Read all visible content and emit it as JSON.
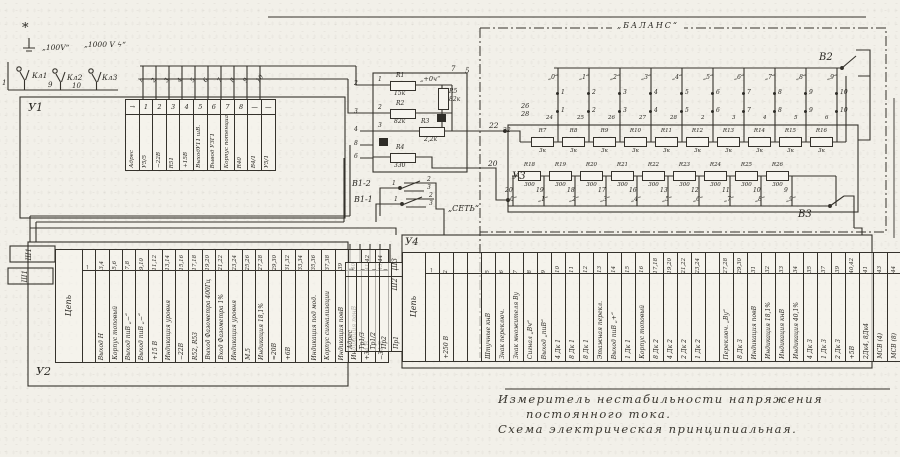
{
  "caption": {
    "line1": "Измеритель  нестабильности  напряжения",
    "line2": "постоянного  тока.",
    "line3": "Схема  электрическая  принципиальная."
  },
  "labels": {
    "star": "*",
    "u1": "У1",
    "u2": "У2",
    "u3": "У3",
    "u4": "У4",
    "v2": "В2",
    "v3": "В3",
    "v12": "В1-2",
    "v11": "В1-1",
    "balance": "„БАЛАНС“",
    "net": "„СЕТЬ“",
    "kl1": "Кл1",
    "kl2": "Кл2",
    "kl3": "Кл3",
    "term1": "1",
    "term9": "9",
    "term10": "10",
    "v100": "„100V“",
    "v1000": "„1000 V ϟ“",
    "sh1a": "Ш1",
    "sh1b": "Ш1",
    "sh3": "Ш3",
    "sh2": "Ш2",
    "bus22": "22",
    "bus22b": "22",
    "bus20": "20",
    "bus26": "26",
    "bus28": "28",
    "node7": "7",
    "node5": "5",
    "plus04": "„+0ч“",
    "sw11_1": "1",
    "sw12_1": "1",
    "c2a": "2",
    "c3a": "3",
    "c2b": "2",
    "c3b": "3"
  },
  "r_block": {
    "pins": [
      "2",
      "3",
      "4",
      "8",
      "6"
    ],
    "taps": [
      "1",
      "2",
      "3"
    ],
    "r1": {
      "name": "R1",
      "value": "15к"
    },
    "r2": {
      "name": "R2",
      "value": "82к"
    },
    "r5": {
      "name": "R5",
      "value": "82к"
    },
    "r3": {
      "name": "R3",
      "value": "2,2к"
    },
    "r4": {
      "name": "R4",
      "value": "330"
    }
  },
  "balance": {
    "positions": [
      "„0“",
      "„1“",
      "„2“",
      "„3“",
      "„4“",
      "„5“",
      "„6“",
      "„7“",
      "„8“",
      "„9“"
    ],
    "contacts_top": [
      "1",
      "2",
      "3",
      "4",
      "5",
      "6",
      "7",
      "8",
      "9",
      "10"
    ],
    "contacts_mid": [
      "1",
      "2",
      "3",
      "4",
      "5",
      "6",
      "7",
      "8",
      "9",
      "10"
    ],
    "contacts_mid2": [
      "24",
      "25",
      "26",
      "27",
      "28",
      "2",
      "3",
      "4",
      "5",
      "6"
    ],
    "row1": [
      {
        "name": "R7",
        "value": "3к"
      },
      {
        "name": "R8",
        "value": "3к"
      },
      {
        "name": "R9",
        "value": "3к"
      },
      {
        "name": "R10",
        "value": "3к"
      },
      {
        "name": "R11",
        "value": "3к"
      },
      {
        "name": "R12",
        "value": "3к"
      },
      {
        "name": "R13",
        "value": "3к"
      },
      {
        "name": "R14",
        "value": "3к"
      },
      {
        "name": "R15",
        "value": "3к"
      },
      {
        "name": "R16",
        "value": "3к"
      }
    ],
    "row2": [
      {
        "name": "R18",
        "value": "300"
      },
      {
        "name": "R19",
        "value": "300"
      },
      {
        "name": "R20",
        "value": "300"
      },
      {
        "name": "R21",
        "value": "300"
      },
      {
        "name": "R22",
        "value": "300"
      },
      {
        "name": "R23",
        "value": "300"
      },
      {
        "name": "R24",
        "value": "300"
      },
      {
        "name": "R25",
        "value": "300"
      },
      {
        "name": "R26",
        "value": "300"
      }
    ],
    "nodes": [
      "20",
      "19",
      "18",
      "17",
      "16",
      "13",
      "12",
      "11",
      "10",
      "9"
    ],
    "node_pos": [
      "„0“",
      "„1“",
      "„2“",
      "„3“",
      "„4“",
      "„5“",
      "„6“",
      "„7“",
      "„8“",
      "„9“"
    ]
  },
  "u1_top_pins": [
    "1",
    "2",
    "3",
    "4",
    "5",
    "6",
    "7",
    "8",
    "9",
    "10"
  ],
  "u1_table": {
    "cols": [
      {
        "pin": "→",
        "label": "Адрес"
      },
      {
        "pin": "1",
        "label": "У5/5"
      },
      {
        "pin": "2",
        "label": "−22В"
      },
      {
        "pin": "3",
        "label": "R51"
      },
      {
        "pin": "4",
        "label": "+15В"
      },
      {
        "pin": "5",
        "label": "ВыходУ11 шВ."
      },
      {
        "pin": "6",
        "label": "Вывод УЗГ1"
      },
      {
        "pin": "7",
        "label": "Корпус потенциальн."
      },
      {
        "pin": "8",
        "label": "R40"
      },
      {
        "pin": "—",
        "label": "В4/1"
      },
      {
        "pin": "—",
        "label": "У5/1"
      }
    ]
  },
  "sh1_table": {
    "header": "Цепь",
    "cols": [
      {
        "pin": "→",
        "label": ""
      },
      {
        "pin": "3,4",
        "label": "Выход Н"
      },
      {
        "pin": "5,6",
        "label": "Корпус топовый"
      },
      {
        "pin": "7,8",
        "label": "Выход пиВ „−“"
      },
      {
        "pin": "9,10",
        "label": "Выход пиВ „−“"
      },
      {
        "pin": "11,12",
        "label": "+15 В"
      },
      {
        "pin": "13,14",
        "label": "Индикация уровня"
      },
      {
        "pin": "15,16",
        "label": "−22В"
      },
      {
        "pin": "17,18",
        "label": "R52, R53"
      },
      {
        "pin": "19,20",
        "label": "Выход Фазометра 400Гц"
      },
      {
        "pin": "21,22",
        "label": "Вход Фазометра 1%"
      },
      {
        "pin": "23,24",
        "label": "Индикация уровня"
      },
      {
        "pin": "25,26",
        "label": "М.5"
      },
      {
        "pin": "27,28",
        "label": "Индикация 18,1%"
      },
      {
        "pin": "29,30",
        "label": "≈20В"
      },
      {
        "pin": "31,32",
        "label": "+6В"
      },
      {
        "pin": "33,34",
        "label": ""
      },
      {
        "pin": "35,36",
        "label": "Индикация под мод."
      },
      {
        "pin": "37,38",
        "label": "Корпус сигнализации"
      },
      {
        "pin": "39",
        "label": "Индикация повВ"
      },
      {
        "pin": "40",
        "label": "Индикация понВ"
      },
      {
        "pin": "41,42",
        "label": "+34 В"
      },
      {
        "pin": "43,44",
        "label": "−34 В"
      }
    ]
  },
  "sh2_table": {
    "header": "Цепь",
    "cols": [
      {
        "pin": "→",
        "label": ""
      },
      {
        "pin": "2",
        "label": "+250 В"
      },
      {
        "pin": "",
        "label": ""
      },
      {
        "pin": "",
        "label": ""
      },
      {
        "pin": "5",
        "label": "Штучные кнВ"
      },
      {
        "pin": "6",
        "label": "Знак переключ."
      },
      {
        "pin": "7",
        "label": "Знак множителя Ву"
      },
      {
        "pin": "8",
        "label": "Сигнал „Вч“"
      },
      {
        "pin": "9",
        "label": "Выход „пиВ“"
      },
      {
        "pin": "10",
        "label": "4 Дк 1"
      },
      {
        "pin": "11",
        "label": "8 Дк 1"
      },
      {
        "pin": "12",
        "label": "8 Дк 1"
      },
      {
        "pin": "13",
        "label": "Этажная перекл."
      },
      {
        "pin": "14",
        "label": "Выход пиВ „+“"
      },
      {
        "pin": "15",
        "label": "1 Дк 1"
      },
      {
        "pin": "16",
        "label": "Корпус топовый"
      },
      {
        "pin": "17,18",
        "label": "8 Дк 2"
      },
      {
        "pin": "19,20",
        "label": "4 Дк 2"
      },
      {
        "pin": "21,22",
        "label": "2 Дк 2"
      },
      {
        "pin": "23,24",
        "label": "1 Дк 2"
      },
      {
        "pin": "",
        "label": ""
      },
      {
        "pin": "27,28",
        "label": "Переключ. „Ву“"
      },
      {
        "pin": "29,30",
        "label": "8 Дк 3"
      },
      {
        "pin": "31",
        "label": "Индикация повВ"
      },
      {
        "pin": "32",
        "label": "Индикация 18,1%"
      },
      {
        "pin": "33",
        "label": "Индикация кнВ"
      },
      {
        "pin": "34",
        "label": "Индикация 40,1%"
      },
      {
        "pin": "35",
        "label": "4 Дк 3"
      },
      {
        "pin": "37",
        "label": "1 Дк 3"
      },
      {
        "pin": "39",
        "label": "2 Дк 3"
      },
      {
        "pin": "40,42",
        "label": "+5В"
      },
      {
        "pin": "41",
        "label": "2Дк4, 8Дк4"
      },
      {
        "pin": "43",
        "label": "МСВ (4)"
      },
      {
        "pin": "44",
        "label": "МСВ (8)"
      }
    ]
  },
  "fuse_table": {
    "cols": [
      {
        "pin": "→",
        "label": "Адрес"
      },
      {
        "pin": "−",
        "label": "Тр1/3"
      },
      {
        "pin": "−",
        "label": "Тр1/2"
      },
      {
        "pin": "−",
        "label": "Пр2"
      },
      {
        "pin": "−",
        "label": "Пр1"
      }
    ]
  }
}
